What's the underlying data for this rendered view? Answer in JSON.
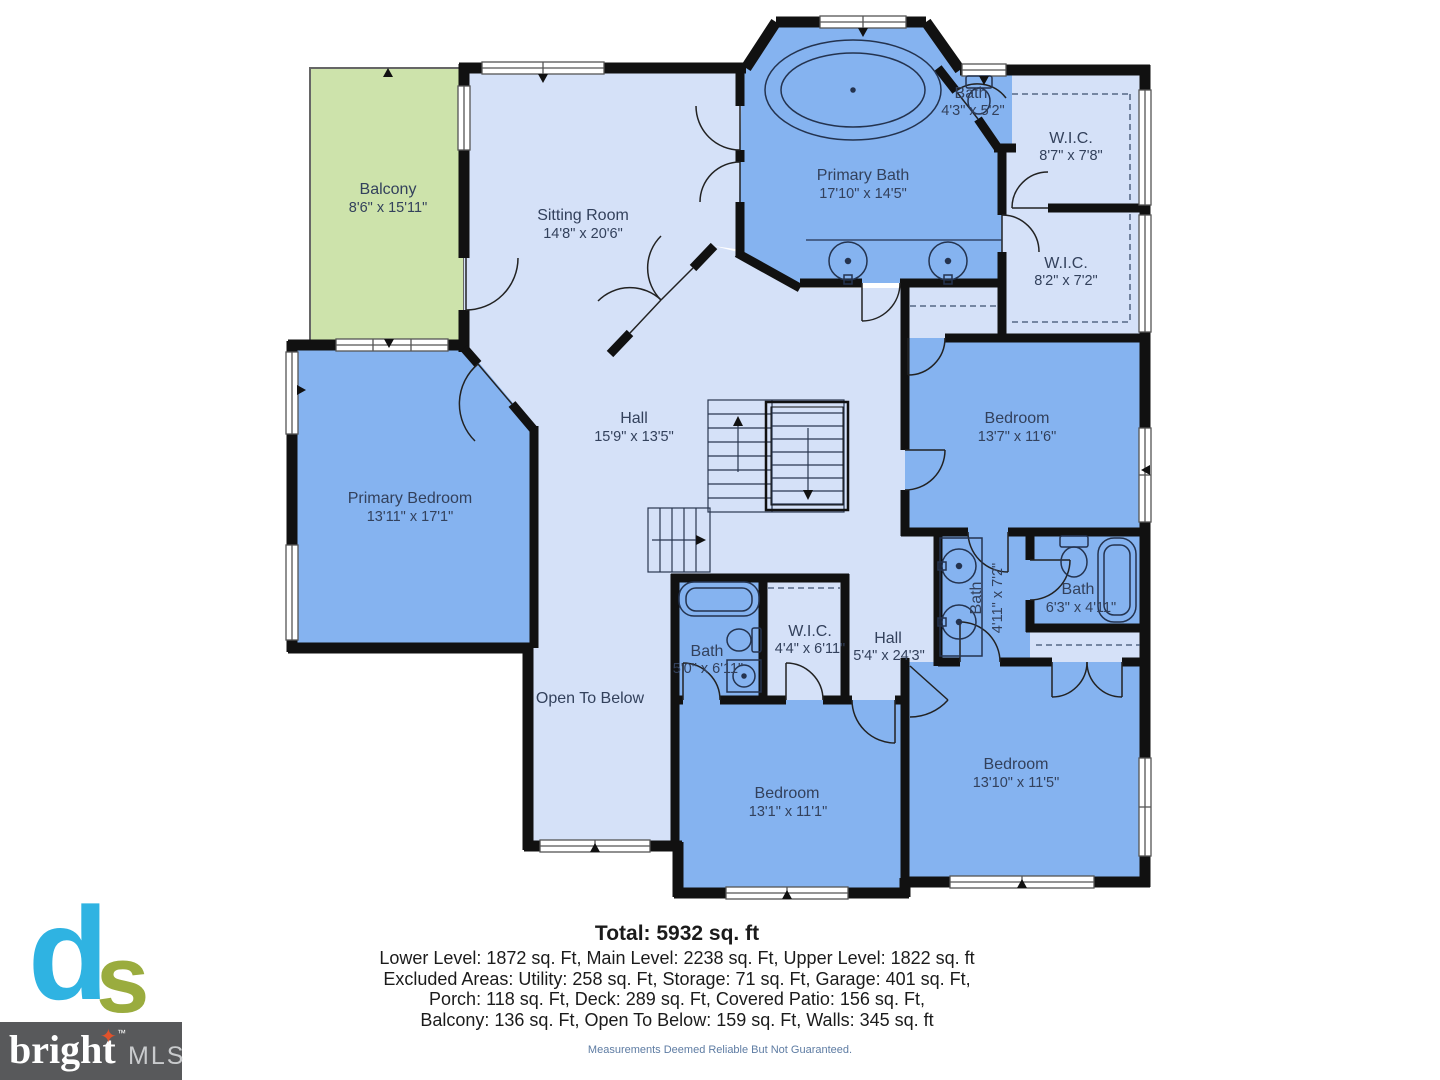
{
  "plan": {
    "rooms": [
      {
        "id": "balcony",
        "name": "Balcony",
        "dims": "8'6\" x 15'11\""
      },
      {
        "id": "sitting-room",
        "name": "Sitting Room",
        "dims": "14'8\" x 20'6\""
      },
      {
        "id": "primary-bath",
        "name": "Primary Bath",
        "dims": "17'10\" x 14'5\""
      },
      {
        "id": "bath-top",
        "name": "Bath",
        "dims": "4'3\" x 5'2\""
      },
      {
        "id": "wic-1",
        "name": "W.I.C.",
        "dims": "8'7\" x 7'8\""
      },
      {
        "id": "wic-2",
        "name": "W.I.C.",
        "dims": "8'2\" x 7'2\""
      },
      {
        "id": "bedroom-1",
        "name": "Bedroom",
        "dims": "13'7\" x 11'6\""
      },
      {
        "id": "hall-upper",
        "name": "Hall",
        "dims": "15'9\" x 13'5\""
      },
      {
        "id": "primary-bedroom",
        "name": "Primary Bedroom",
        "dims": "13'11\" x 17'1\""
      },
      {
        "id": "bath-jack-jill",
        "name": "Bath",
        "dims": "4'11\" x 7'2\""
      },
      {
        "id": "bath-right",
        "name": "Bath",
        "dims": "6'3\" x 4'11\""
      },
      {
        "id": "bath-left",
        "name": "Bath",
        "dims": "5'0\" x 6'11\""
      },
      {
        "id": "wic-3",
        "name": "W.I.C.",
        "dims": "4'4\" x 6'11\""
      },
      {
        "id": "hall-lower",
        "name": "Hall",
        "dims": "5'4\" x 24'3\""
      },
      {
        "id": "open-to-below",
        "name": "Open To Below",
        "dims": ""
      },
      {
        "id": "bedroom-2",
        "name": "Bedroom",
        "dims": "13'1\" x 11'1\""
      },
      {
        "id": "bedroom-3",
        "name": "Bedroom",
        "dims": "13'10\" x 11'5\""
      }
    ]
  },
  "summary": {
    "total": "Total: 5932 sq. ft",
    "line1": "Lower Level: 1872 sq. Ft, Main Level: 2238 sq. Ft, Upper Level: 1822 sq. ft",
    "line2": "Excluded Areas: Utility: 258 sq. Ft, Storage: 71 sq. Ft, Garage: 401 sq. Ft,",
    "line3": "Porch: 118 sq. Ft, Deck: 289 sq. Ft, Covered Patio: 156 sq. Ft,",
    "line4": "Balcony: 136 sq. Ft, Open To Below: 159 sq. Ft, Walls: 345 sq. ft",
    "disclaimer": "Measurements Deemed Reliable But Not Guaranteed."
  },
  "logo": {
    "mark_d": "d",
    "mark_s": "s",
    "brand": "bright",
    "star": "✦",
    "tm": "™",
    "suffix": "MLS"
  },
  "colors": {
    "room_blue": "#85b3f0",
    "room_light_blue": "#d5e1f8",
    "balcony_green": "#cde3ab",
    "wall": "#111111",
    "label_text": "#33415c",
    "logo_cyan": "#2fb3e2",
    "logo_green": "#9aac3e",
    "logo_gray": "#58595b",
    "logo_star": "#e0522b",
    "disclaimer_text": "#5e7ca3"
  }
}
